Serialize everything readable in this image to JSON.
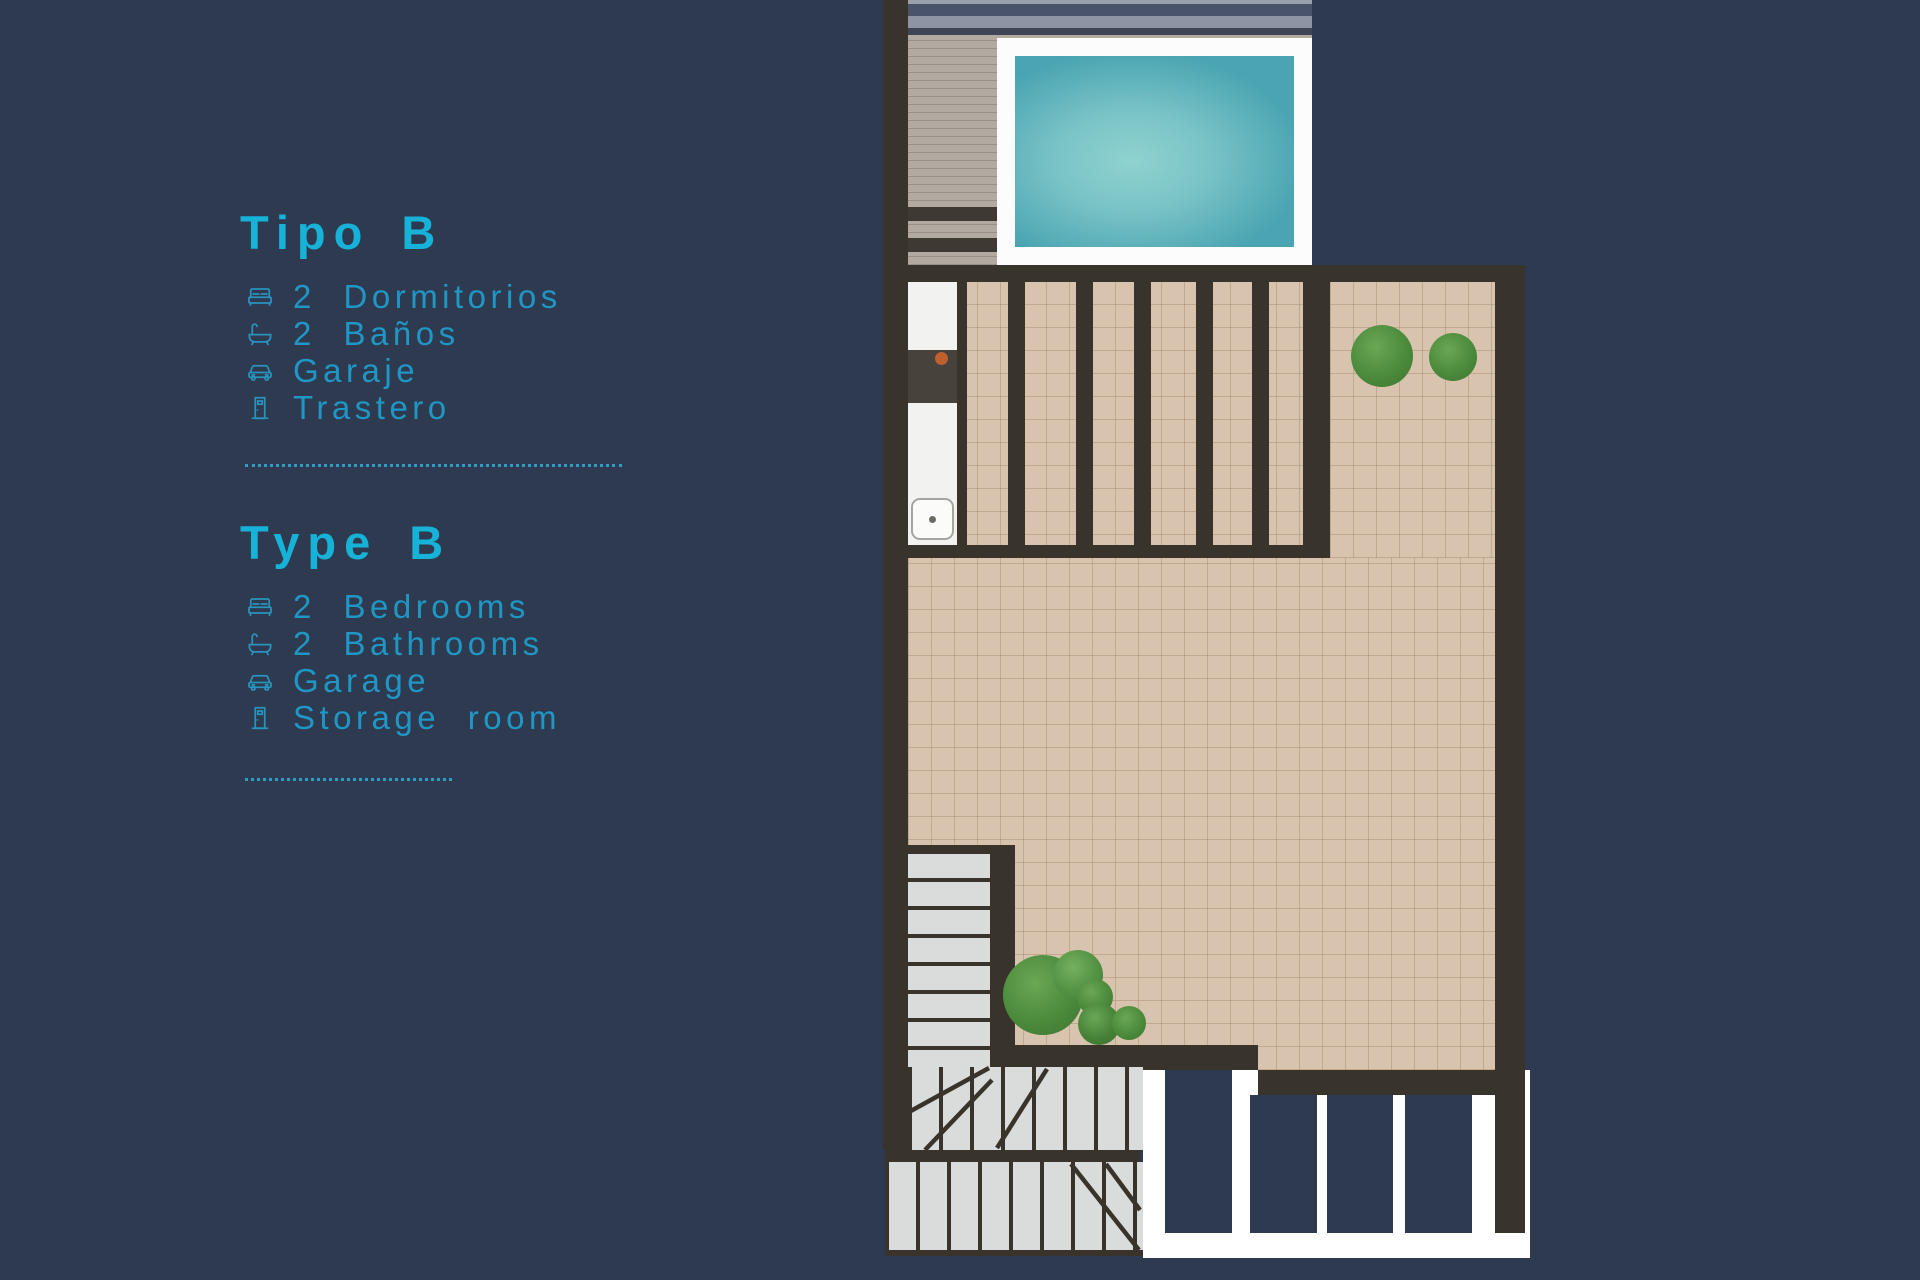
{
  "panel": {
    "sections": [
      {
        "id": "tipo",
        "title": "Tipo B",
        "items": [
          {
            "icon": "bed-icon",
            "label": "2 Dormitorios"
          },
          {
            "icon": "bath-icon",
            "label": "2 Baños"
          },
          {
            "icon": "car-icon",
            "label": "Garaje"
          },
          {
            "icon": "door-icon",
            "label": "Trastero"
          }
        ]
      },
      {
        "id": "type",
        "title": "Type B",
        "items": [
          {
            "icon": "bed-icon",
            "label": "2 Bedrooms"
          },
          {
            "icon": "bath-icon",
            "label": "2 Bathrooms"
          },
          {
            "icon": "car-icon",
            "label": "Garage"
          },
          {
            "icon": "door-icon",
            "label": "Storage room"
          }
        ]
      }
    ]
  },
  "floorplan": {
    "features": [
      "pool",
      "wood-deck",
      "pergola-terrace",
      "kitchen-counter",
      "tiled-terrace",
      "staircase",
      "planters",
      "garage-front"
    ],
    "colors": {
      "background": "#2d3a4f",
      "accent_cyan": "#16b2d8",
      "item_cyan": "#2096c4",
      "wall": "#38332b",
      "tile": "#d7c3ae",
      "deck": "#b2a9a1",
      "pool_frame": "#fcfcfc",
      "pool_water_dark": "#3f98a9",
      "pool_water_light": "#90d2d0",
      "stairs": "#d9dcda",
      "bush_green": "#4c8a3c",
      "garage_panel": "#2d3a4f",
      "cooktop": "#47423b",
      "burner": "#bf5f2e"
    }
  }
}
